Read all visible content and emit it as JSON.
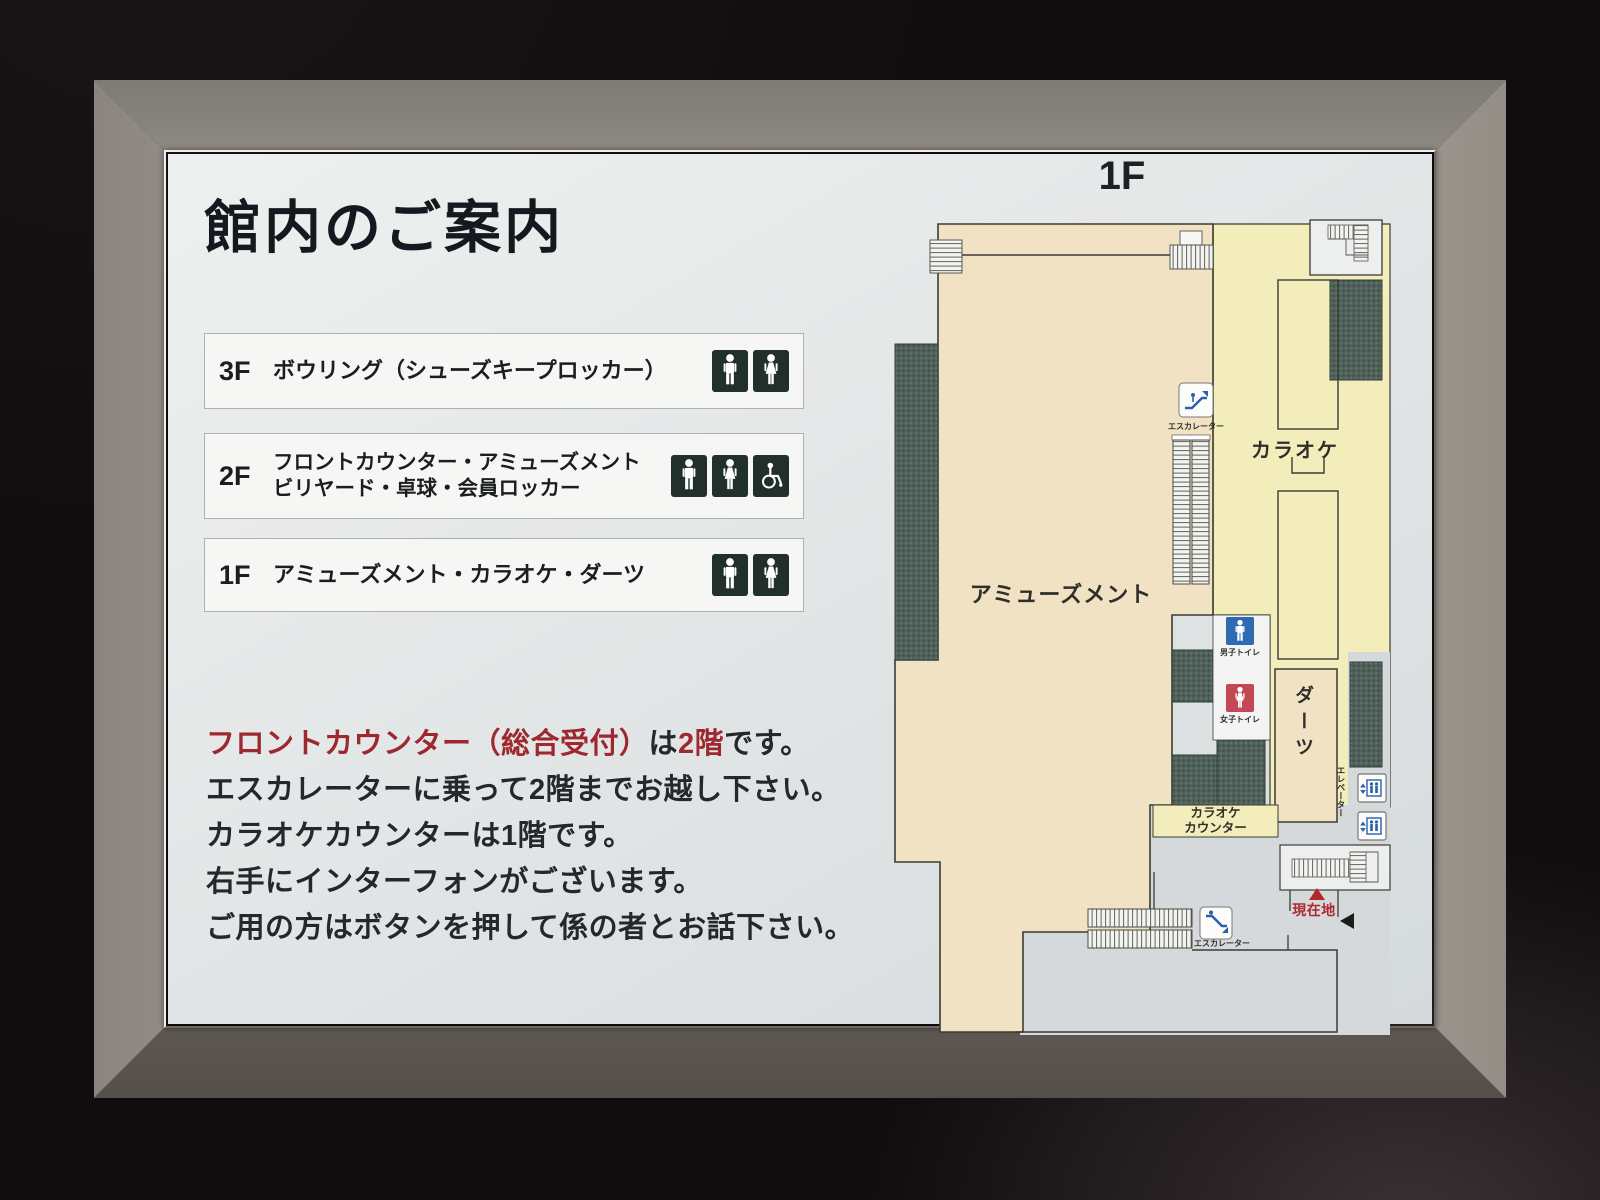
{
  "sign": {
    "title": "館内のご案内",
    "map_floor_label": "1F",
    "floors": [
      {
        "floor": "3F",
        "label": "ボウリング（シューズキープロッカー）",
        "icons": [
          "male-restroom-icon",
          "female-restroom-icon"
        ]
      },
      {
        "floor": "2F",
        "label_line1": "フロントカウンター・アミューズメント",
        "label_line2": "ビリヤード・卓球・会員ロッカー",
        "icons": [
          "male-restroom-icon",
          "female-restroom-icon",
          "wheelchair-icon"
        ]
      },
      {
        "floor": "1F",
        "label": "アミューズメント・カラオケ・ダーツ",
        "icons": [
          "male-restroom-icon",
          "female-restroom-icon"
        ]
      }
    ],
    "notice": {
      "line1": {
        "seg1_red": "フロントカウンター（総合受付）",
        "seg2": "は",
        "seg3_red": "2階",
        "seg4": "です。"
      },
      "line2": "エスカレーターに乗って2階までお越し下さい。",
      "line3": "カラオケカウンターは1階です。",
      "line4": "右手にインターフォンがございます。",
      "line5": "ご用の方はボタンを押して係の者とお話下さい。"
    },
    "map": {
      "areas": {
        "amusement": "アミューズメント",
        "karaoke": "カラオケ",
        "darts": "ダーツ",
        "karaoke_counter_line1": "カラオケ",
        "karaoke_counter_line2": "カウンター"
      },
      "labels": {
        "escalator_upper": "エスカレーター",
        "escalator_lower": "エスカレーター",
        "elevator": "エレベーター",
        "mens_toilet": "男子トイレ",
        "womens_toilet": "女子トイレ",
        "current_location": "現在地"
      }
    },
    "colors": {
      "accent_red": "#9e2830",
      "current_location_red": "#b3262c",
      "map_tan": "#f0e2c3",
      "map_yellow": "#f3edbb",
      "map_hatch_green": "#4f6159",
      "toilet_blue": "#2e6cb2",
      "toilet_pink": "#c14854",
      "frame_silver": "#c6c1b8"
    }
  }
}
